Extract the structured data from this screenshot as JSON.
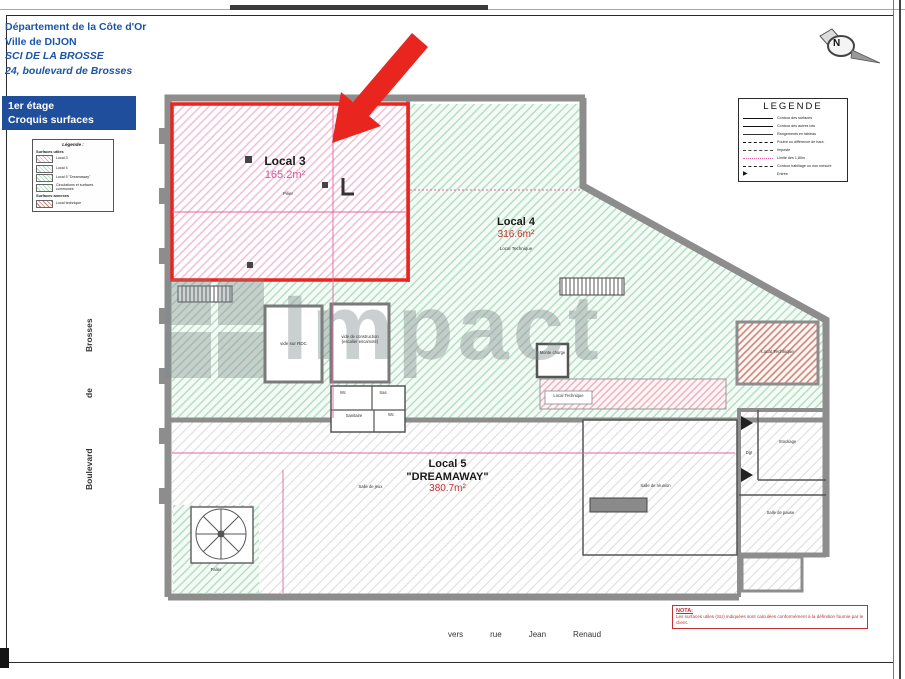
{
  "header": {
    "lines": [
      "Département de la Côte d'Or",
      "Ville de DIJON",
      "SCI DE LA BROSSE",
      "24, boulevard de Brosses"
    ],
    "stage_box": {
      "line1": "1er étage",
      "line2": "Croquis surfaces"
    }
  },
  "mini_legend": {
    "title": "Légende :",
    "sections": [
      {
        "heading": "Surfaces utiles",
        "items": [
          {
            "label": "Local 3"
          },
          {
            "label": "Local 4"
          },
          {
            "label": "Local 5 \"Dreamaway\""
          },
          {
            "label": "Circulations et surfaces communes"
          }
        ]
      },
      {
        "heading": "Surfaces annexes",
        "items": [
          {
            "label": "Local technique"
          }
        ]
      }
    ]
  },
  "legend": {
    "title": "LEGENDE",
    "entries": [
      {
        "label": "Contour des surfaces"
      },
      {
        "label": "Contour des autres lots"
      },
      {
        "label": "Rangements en tableau"
      },
      {
        "label": "Poutre ou différence de haut."
      },
      {
        "label": "Imposte"
      },
      {
        "label": "Limite des 1,80m"
      },
      {
        "label": "Contour habillage ou non mesuré"
      },
      {
        "label": "Entrée"
      }
    ]
  },
  "north_label": "N",
  "watermark": "Impact",
  "plan": {
    "local3": {
      "name": "Local 3",
      "area": "165.2m²",
      "note": "Pilier"
    },
    "local4": {
      "name": "Local 4",
      "area": "316.6m²",
      "note": "Local Technique"
    },
    "local5": {
      "name": "Local 5",
      "alias": "\"DREAMAWAY\"",
      "area": "380.7m²"
    },
    "rooms": {
      "vide_rdc": "vide sur RDC",
      "vide_conf_1": "vide de construction",
      "vide_conf_2": "(escalier escamoté)",
      "monte_charge": "Monte charge",
      "local_technique_band": "Local Technique",
      "local_technique_box": "Local Technique",
      "sanitaire": "Sanitaire",
      "wc1": "Wc",
      "wc2": "Wc",
      "sas": "Sas",
      "dgt": "Dgt",
      "stockage": "Stockage",
      "salle_reunion": "Salle de réunion",
      "salle_pause": "Salle de pause",
      "salle_jeux": "Salle de jeux",
      "palier": "Palier"
    },
    "street": {
      "word1": "Brosses",
      "word2": "de",
      "word3": "Boulevard"
    }
  },
  "nota": {
    "title": "NOTA:",
    "text": "Les surfaces utiles (SU) indiquées sont calculées conformément à la définition fournie par le client."
  },
  "footer": {
    "words": [
      "vers",
      "rue",
      "Jean",
      "Renaud"
    ]
  }
}
